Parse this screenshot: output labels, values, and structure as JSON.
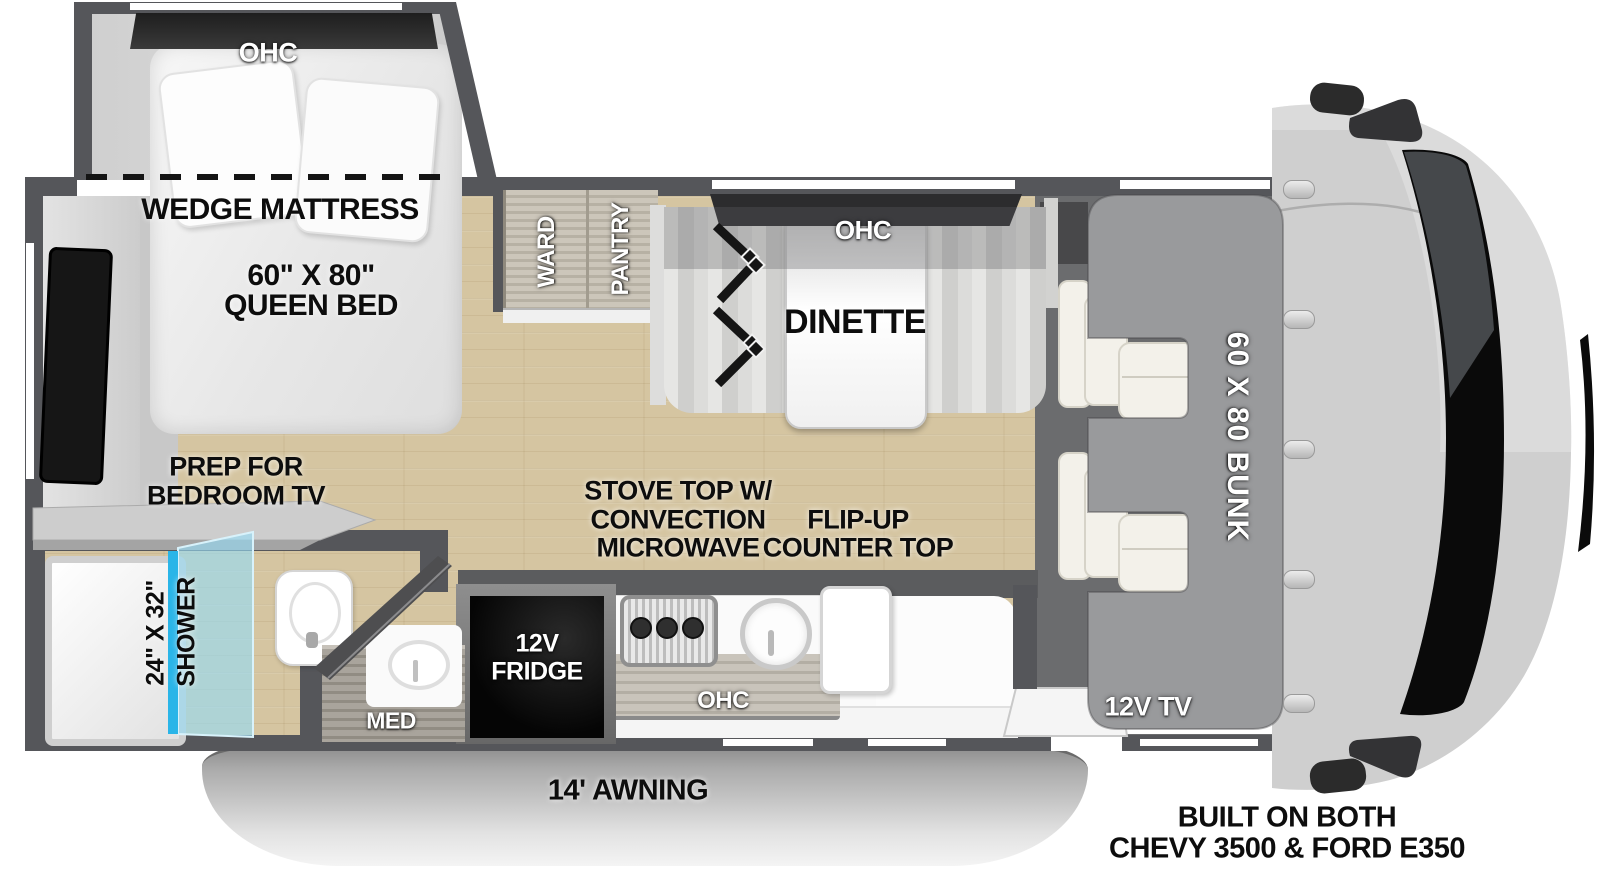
{
  "colors": {
    "wall_gray": "#55565a",
    "floor_tan": "#d5c5a1",
    "bunk_gray": "#999a9c",
    "shower_glass_blue": "#2ab5e8",
    "cabinet_taupe": "#c4beb1",
    "awning_gray": "#c7c7c7",
    "appliance_black": "#0a0a0a"
  },
  "bedroom": {
    "ohc": "OHC",
    "mattress": "WEDGE MATTRESS",
    "size": "60\" X 80\"",
    "type": "QUEEN BED",
    "prep1": "PREP FOR",
    "prep2": "BEDROOM TV"
  },
  "bath": {
    "size": "24\" X 32\"",
    "shower": "SHOWER",
    "med": "MED"
  },
  "storage": {
    "ward": "WARD",
    "pantry": "PANTRY"
  },
  "dinette": {
    "ohc": "OHC",
    "name": "DINETTE"
  },
  "kitchen": {
    "stove1": "STOVE TOP W/",
    "stove2": "CONVECTION",
    "stove3": "MICROWAVE",
    "flip1": "FLIP-UP",
    "flip2": "COUNTER TOP",
    "fridge1": "12V",
    "fridge2": "FRIDGE",
    "ohc": "OHC"
  },
  "cab": {
    "bunk": "60 X 80 BUNK",
    "tv": "12V TV"
  },
  "exterior": {
    "awning": "14' AWNING",
    "built1": "BUILT ON BOTH",
    "built2": "CHEVY 3500 & FORD E350"
  }
}
